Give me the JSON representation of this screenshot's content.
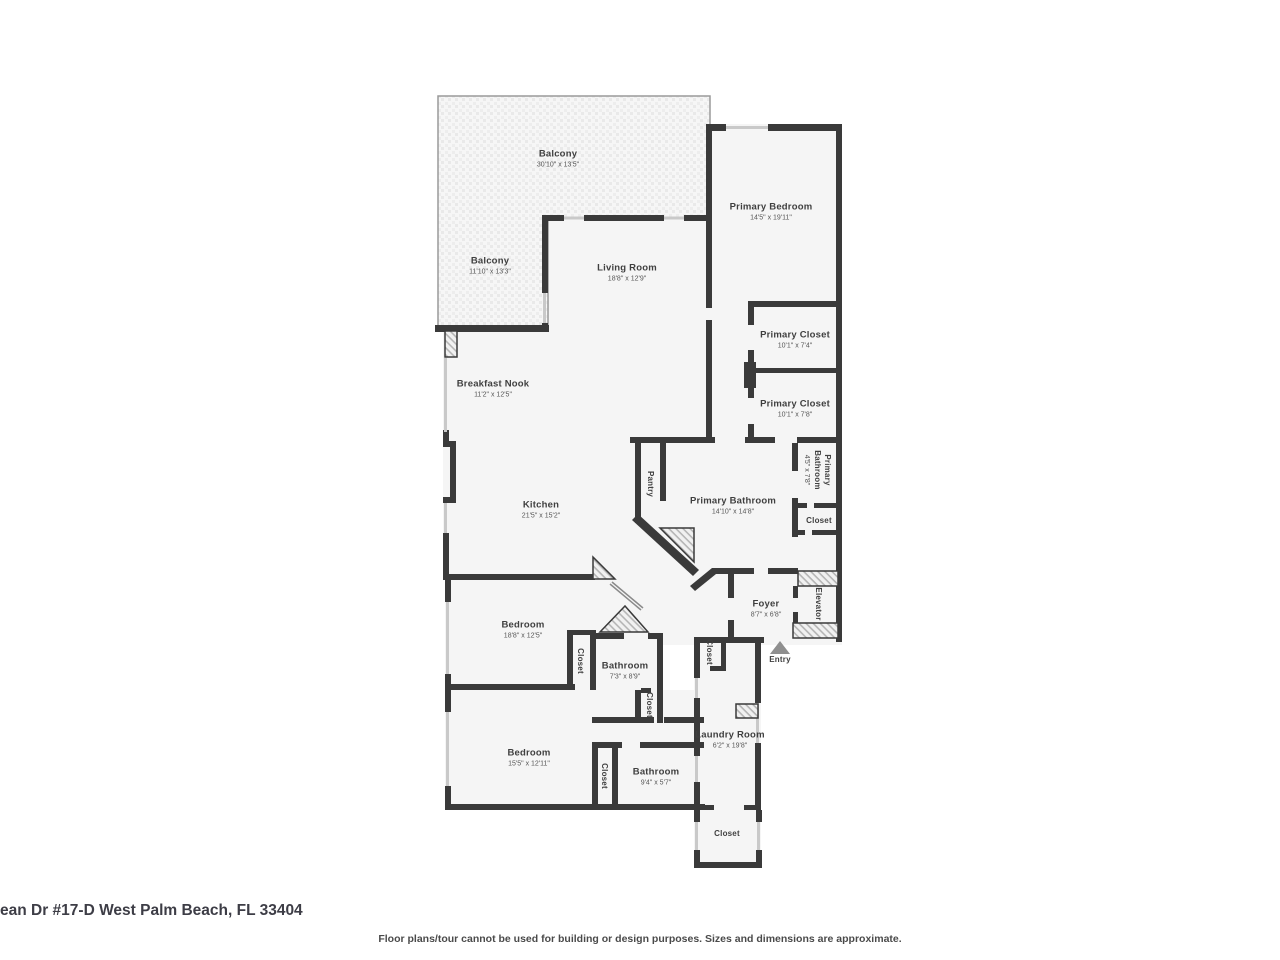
{
  "address": "ean Dr #17-D West Palm Beach, FL 33404",
  "disclaimer": "Floor plans/tour cannot be used for building or design purposes. Sizes and dimensions are approximate.",
  "colors": {
    "wall": "#3a3a3a",
    "room_fill": "#f5f5f5",
    "text": "#3f3f3f",
    "entry_arrow": "#8f8f8f"
  },
  "entry": {
    "label": "Entry"
  },
  "rooms": {
    "balcony_top": {
      "name": "Balcony",
      "dims": "30'10\" x 13'5\""
    },
    "balcony_left": {
      "name": "Balcony",
      "dims": "11'10\" x 13'3\""
    },
    "living_room": {
      "name": "Living Room",
      "dims": "18'8\" x 12'9\""
    },
    "primary_bedroom": {
      "name": "Primary Bedroom",
      "dims": "14'5\" x 19'11\""
    },
    "primary_closet_1": {
      "name": "Primary Closet",
      "dims": "10'1\" x 7'4\""
    },
    "primary_closet_2": {
      "name": "Primary Closet",
      "dims": "10'1\" x 7'8\""
    },
    "breakfast_nook": {
      "name": "Breakfast Nook",
      "dims": "11'2\" x 12'5\""
    },
    "kitchen": {
      "name": "Kitchen",
      "dims": "21'5\" x 15'2\""
    },
    "pantry": {
      "name": "Pantry"
    },
    "primary_bathroom": {
      "name": "Primary Bathroom",
      "dims": "14'10\" x 14'8\""
    },
    "primary_bathroom_2": {
      "name": "Primary Bathroom",
      "dims": "4'5\" x 7'8\""
    },
    "closet_primary": {
      "name": "Closet"
    },
    "elevator": {
      "name": "Elevator"
    },
    "foyer": {
      "name": "Foyer",
      "dims": "8'7\" x 6'8\""
    },
    "bedroom_mid": {
      "name": "Bedroom",
      "dims": "18'8\" x 12'5\""
    },
    "closet_mid_bedroom": {
      "name": "Closet"
    },
    "bathroom_mid": {
      "name": "Bathroom",
      "dims": "7'3\" x 8'9\""
    },
    "closet_mid_bathroom": {
      "name": "Closet"
    },
    "closet_foyer": {
      "name": "Closet"
    },
    "laundry_room": {
      "name": "Laundry Room",
      "dims": "6'2\" x 19'8\""
    },
    "bedroom_bottom": {
      "name": "Bedroom",
      "dims": "15'5\" x 12'11\""
    },
    "closet_bottom_bed": {
      "name": "Closet"
    },
    "bathroom_bottom": {
      "name": "Bathroom",
      "dims": "9'4\" x 5'7\""
    },
    "closet_bottom": {
      "name": "Closet"
    }
  }
}
